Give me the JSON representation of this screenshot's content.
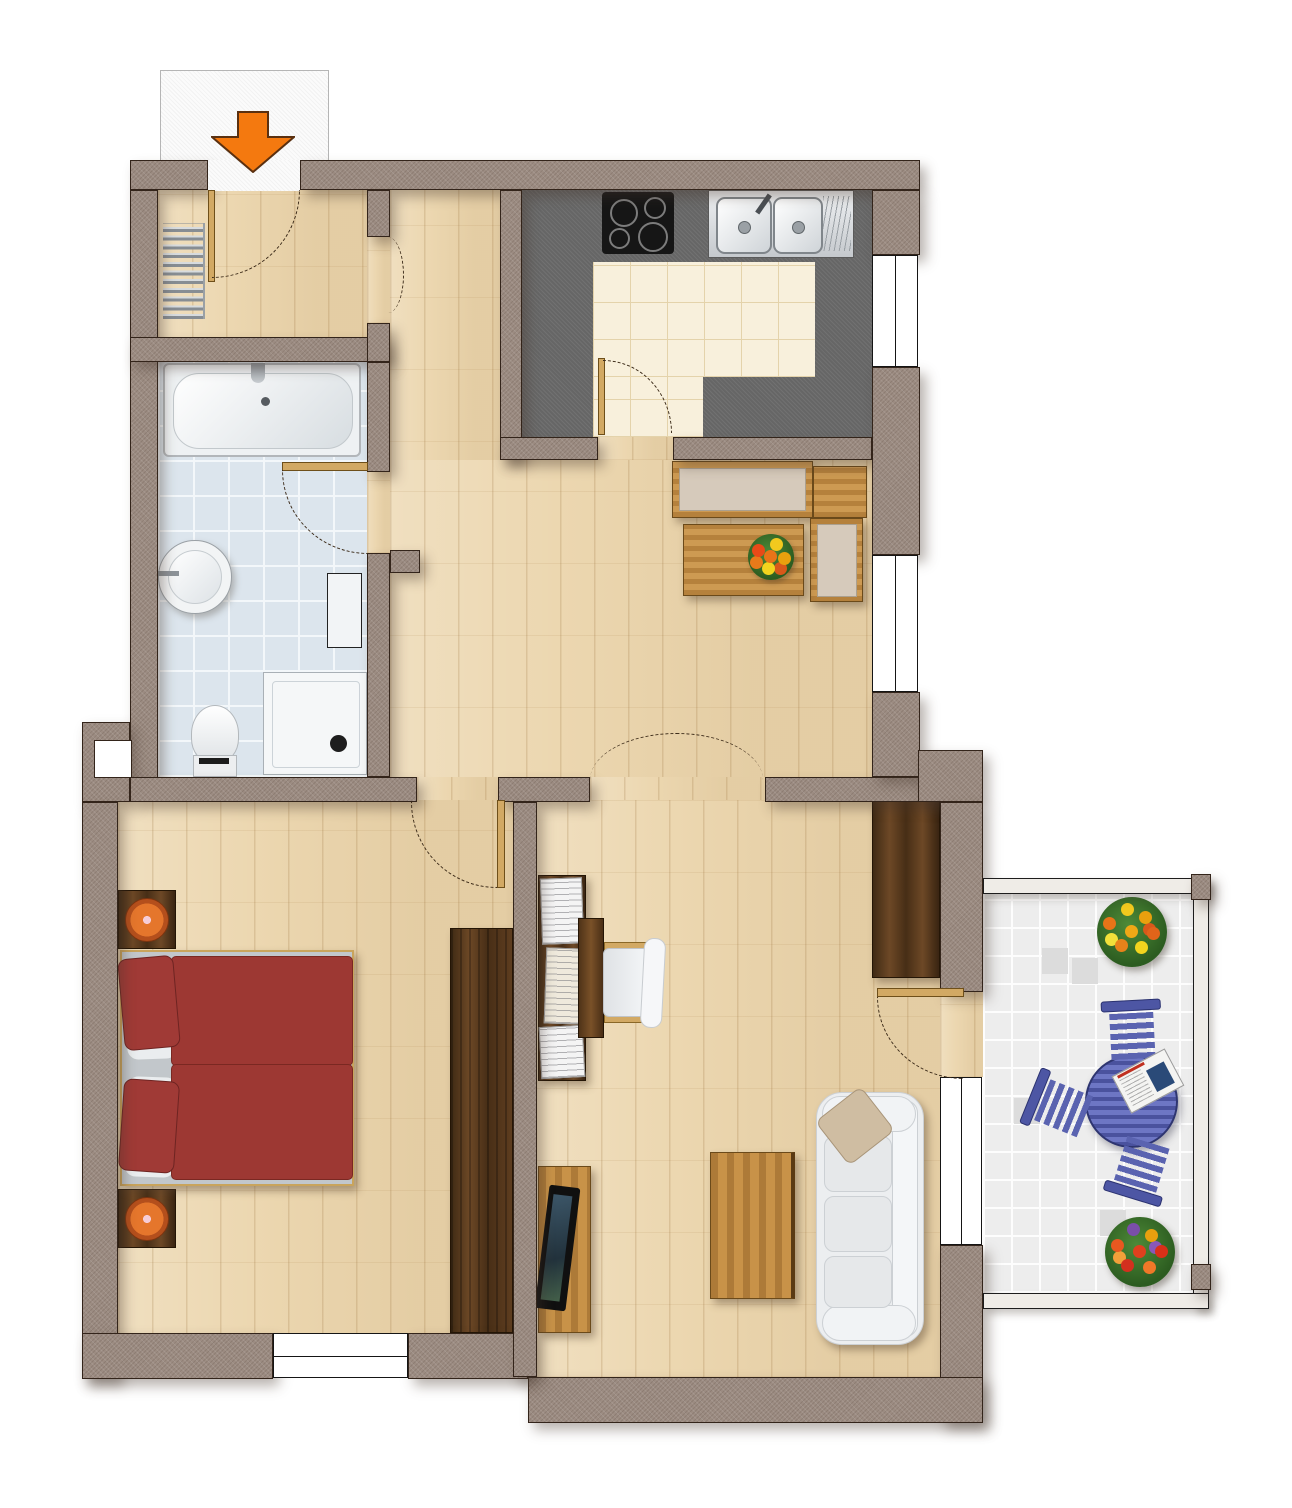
{
  "document": {
    "type": "apartment-floor-plan",
    "view": "top-down",
    "visible_text": "none",
    "entrance_marker": "orange arrow pointing down into entry hall"
  },
  "colors": {
    "wall": "#9c8c82",
    "wood": "#ecd7b0",
    "counter": "#666666",
    "ktile": "#f8f0dc",
    "btile": "#dce5ed",
    "baltile": "#ededed",
    "leaf": "#d2a964",
    "arc": "#3b2a18",
    "cushion": "#d6cabb",
    "blue": "#5a63b0",
    "orange": "#f4790f",
    "bedred": "#9d3833"
  },
  "rooms": [
    {
      "id": "entry-hall",
      "features": [
        "entrance-door",
        "radiator",
        "door-to-corridor"
      ]
    },
    {
      "id": "bathroom",
      "features": [
        "bathtub",
        "round-sink",
        "toilet",
        "shower",
        "cabinet",
        "blue-tile-floor"
      ]
    },
    {
      "id": "kitchen",
      "features": [
        "cooktop-4-burners",
        "double-sink-with-drainboard",
        "l-shaped-counter",
        "cream-tile-floor",
        "window"
      ]
    },
    {
      "id": "dining-area",
      "features": [
        "corner-bench",
        "dining-table",
        "flower-centerpiece",
        "window"
      ]
    },
    {
      "id": "bedroom",
      "features": [
        "double-bed-red-bedding",
        "2-nightstands-with-lamps",
        "wardrobe",
        "window"
      ]
    },
    {
      "id": "living-room",
      "features": [
        "bookshelf",
        "desk",
        "chair",
        "tv-on-stand",
        "coffee-table",
        "white-sofa",
        "sideboard",
        "balcony-door",
        "window"
      ]
    },
    {
      "id": "balcony",
      "features": [
        "round-blue-table",
        "3-blue-chairs",
        "magazine",
        "2-flower-pots",
        "white-tile-floor",
        "railing"
      ]
    }
  ],
  "windows_count": 4,
  "doors_count": 6
}
